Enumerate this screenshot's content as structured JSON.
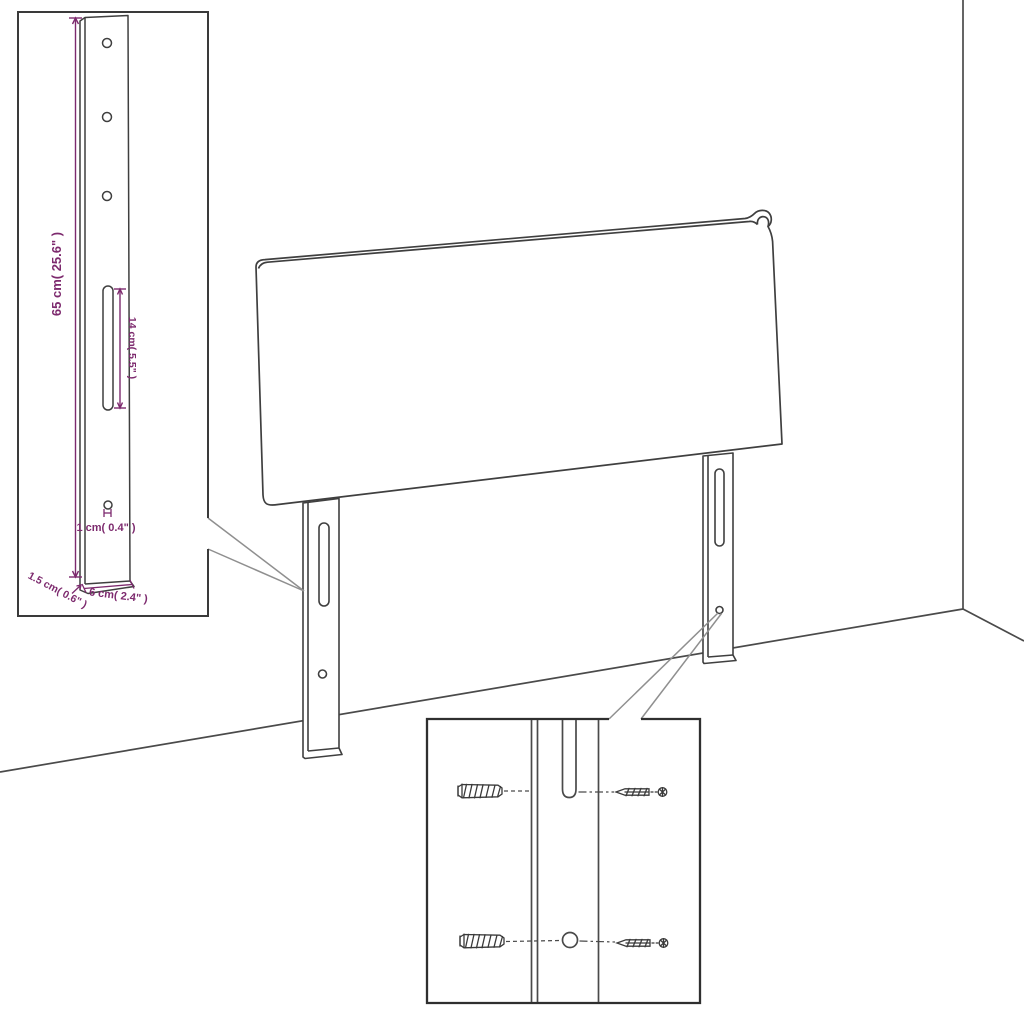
{
  "title": "Headboard mounting dimension diagram",
  "colors": {
    "outline": "#3f3f3f",
    "inset_border": "#2f2f2f",
    "dimension": "#7d2a6e",
    "leader": "#8f8f8f",
    "background": "#ffffff"
  },
  "leg_detail": {
    "labels": {
      "height": "65 cm( 25.6\" )",
      "slot": "14 cm( 5.5\" )",
      "hole": "1 cm( 0.4\" )",
      "thickness": "1.5 cm( 0.6\" )",
      "width": "6 cm( 2.4\" )"
    }
  }
}
